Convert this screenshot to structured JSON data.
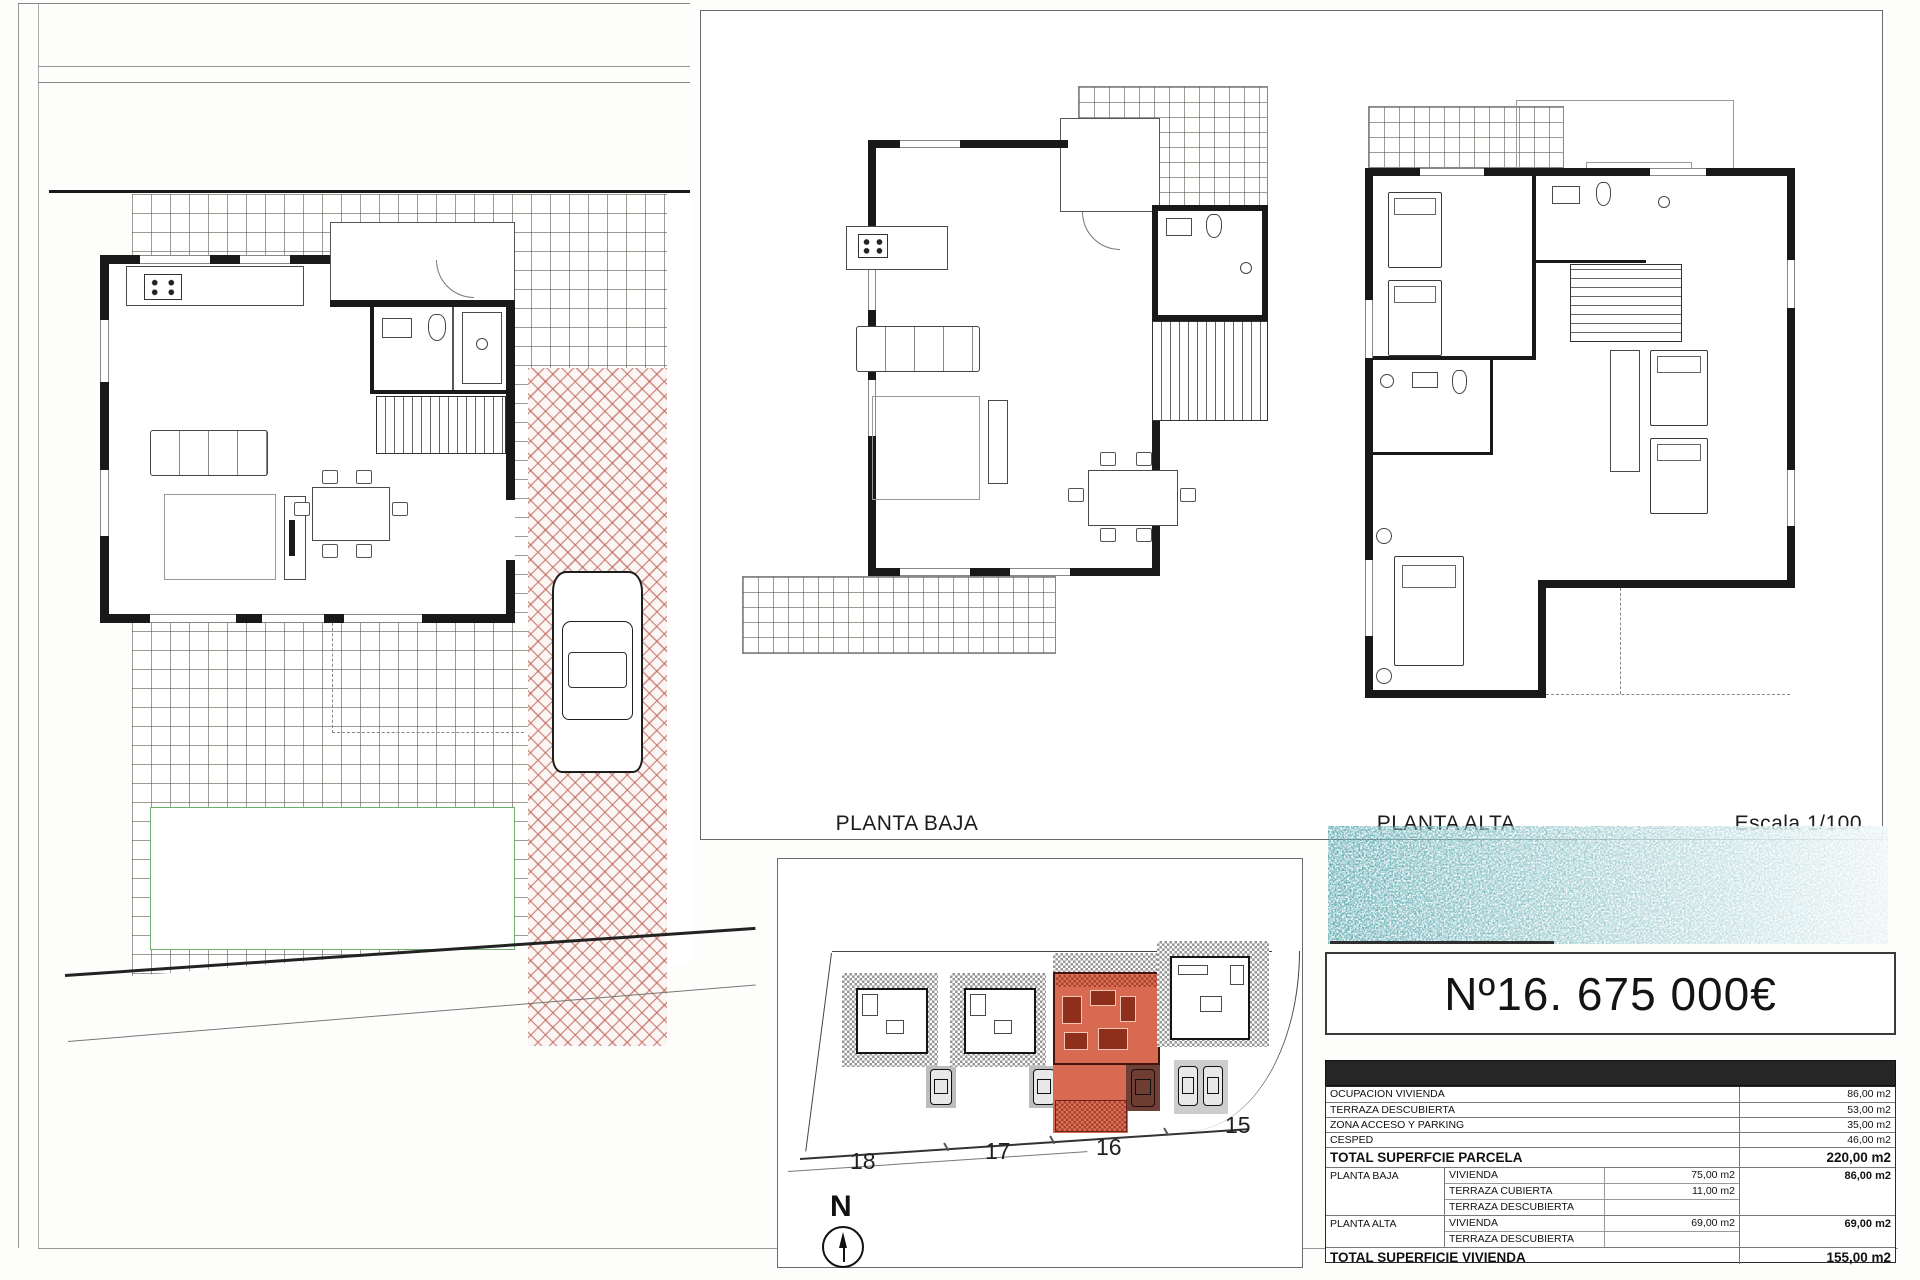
{
  "document": {
    "scale_label": "Escala 1/100"
  },
  "floor_plans": {
    "planta_baja_label": "PLANTA BAJA",
    "planta_alta_label": "PLANTA ALTA"
  },
  "location_plan": {
    "plot_numbers": [
      "18",
      "17",
      "16",
      "15"
    ],
    "north_label": "N"
  },
  "listing": {
    "price_title": "Nº16. 675 000€"
  },
  "area_table": {
    "parcel_rows": [
      {
        "label": "OCUPACION VIVIENDA",
        "value": "86,00 m2"
      },
      {
        "label": "TERRAZA DESCUBIERTA",
        "value": "53,00 m2"
      },
      {
        "label": "ZONA ACCESO Y PARKING",
        "value": "35,00 m2"
      },
      {
        "label": "CESPED",
        "value": "46,00 m2"
      }
    ],
    "total_parcel": {
      "label": "TOTAL SUPERFCIE PARCELA",
      "value": "220,00 m2"
    },
    "floors": [
      {
        "label": "PLANTA BAJA",
        "total": "86,00 m2",
        "rows": [
          {
            "name": "VIVIENDA",
            "value": "75,00 m2"
          },
          {
            "name": "TERRAZA CUBIERTA",
            "value": "11,00 m2"
          },
          {
            "name": "TERRAZA DESCUBIERTA",
            "value": ""
          }
        ]
      },
      {
        "label": "PLANTA ALTA",
        "total": "69,00 m2",
        "rows": [
          {
            "name": "VIVIENDA",
            "value": "69,00 m2"
          },
          {
            "name": "TERRAZA DESCUBIERTA",
            "value": ""
          }
        ]
      }
    ],
    "total_dwelling": {
      "label": "TOTAL SUPERFICIE VIVIENDA",
      "value": "155,00 m2"
    }
  },
  "colors": {
    "highlight_plot": "#d96a52",
    "herringbone": "#ba584a",
    "lawn_border": "#6fae6f",
    "watermark": "#2a6f7a"
  }
}
